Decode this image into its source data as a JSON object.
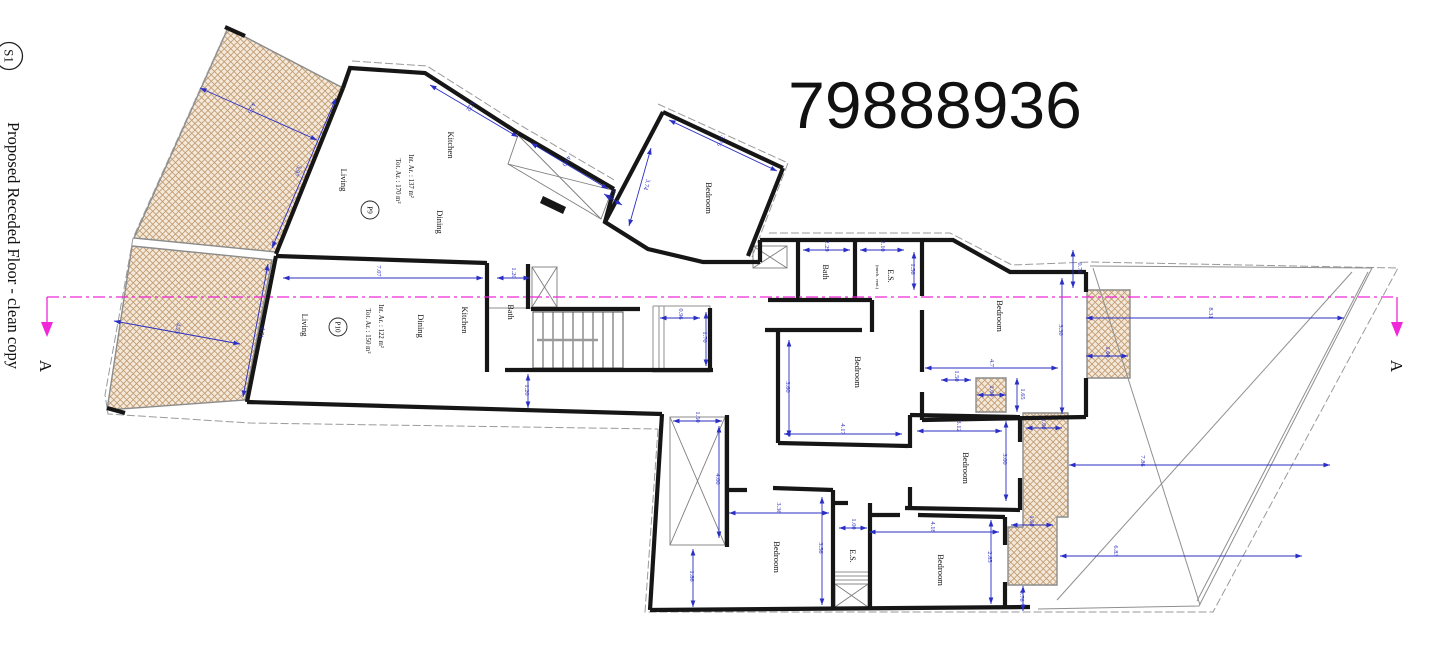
{
  "sheet": {
    "marker": "S1",
    "title": "Proposed Receded Floor - clean copy",
    "drawing_number": "79888936",
    "section_label": "A"
  },
  "apartments": [
    {
      "id": "P9",
      "int_area": "Int. Ar. : 137 m²",
      "tot_area": "Tot. Ar. : 170 m²"
    },
    {
      "id": "P10",
      "int_area": "Int. Ar. : 122 m²",
      "tot_area": "Tot. Ar. : 150 m²"
    }
  ],
  "colors": {
    "wall": "#161616",
    "dimension": "#2a2ec4",
    "section_line": "#ef27d8",
    "boundary": "#9a9a9a",
    "hatch_fill": "#f3e8da",
    "hatch_line": "#c09a6e"
  },
  "plan": {
    "hatches": [
      "228,28 343,88 276,252 134,238",
      "132,246 272,260 245,400 107,410",
      "1087,290 1130,290 1130,378 1087,378",
      "976,378 1006,378 1006,412 976,412",
      "1023,413 1068,413 1068,517 1057,517 1057,585 1008,585 1008,527 1023,527"
    ],
    "boundary": [
      "228,27 133,238 105,395 108,414 250,423 658,429",
      "658,429 645,612 1213,612 1398,268 1090,262 1012,265 950,233 766,233",
      "352,61 427,66 520,125 616,181",
      "658,104 788,163 752,257"
    ],
    "thin": [
      "1090,266 1372,268 1199,606 1038,609",
      "1093,268 1200,605",
      "1057,600 1352,272",
      "1368,272 1197,601",
      "653,306 710,306 710,372 653,372 653,306",
      "659,306 659,372",
      "664,306 664,372",
      "835,572 868,572",
      "835,576 868,576",
      "835,580 868,580",
      "487,308 531,308"
    ],
    "xboxes": [
      [
        532,
        267,
        25,
        40
      ],
      [
        753,
        246,
        34,
        22
      ],
      [
        835,
        584,
        33,
        23
      ],
      [
        670,
        417,
        55,
        128
      ]
    ],
    "xquads": [
      "518,135 612,190 601,219 508,164"
    ],
    "fills": [
      "543,196 566,207 563,214 540,203"
    ],
    "stairs": {
      "x": 533,
      "y": 312,
      "w": 90,
      "h": 56,
      "treads": 8
    },
    "walls": [
      "343,88 276,254",
      "343,88 350,68 425,73 518,133",
      "518,133 614,189",
      "614,189 605,222 648,249 703,262 760,262",
      "663,112 783,168",
      "663,112 605,222",
      "783,168 748,256",
      "760,240 953,240 1010,272 1086,272",
      "760,240 760,262",
      "1086,272 1086,292",
      "1086,378 1086,417",
      "798,240 798,302",
      "855,240 855,302",
      "922,240 922,296",
      "768,300 872,300",
      "872,300 872,332",
      "276,256 487,263",
      "487,263 487,372",
      "528,264 528,309",
      "531,309 640,309",
      "276,256 247,402",
      "247,402 662,414",
      "662,414 650,610",
      "650,610 1030,607",
      "505,370 713,370",
      "710,308 710,370",
      "727,415 727,547",
      "727,490 747,490",
      "773,488 833,490",
      "833,490 833,608",
      "870,503 870,608",
      "833,503 848,503",
      "778,332 778,443",
      "765,330 862,330",
      "778,443 908,446",
      "922,310 922,372",
      "922,392 922,420",
      "922,420 1086,417",
      "910,415 1020,417",
      "910,415 910,448",
      "910,487 910,508",
      "905,508 1020,510",
      "1020,417 1020,442",
      "1020,478 1020,510",
      "868,515 900,515",
      "918,515 1005,517",
      "1005,517 1005,545",
      "1005,582 1005,608",
      "225,27 245,36",
      "107,408 125,413"
    ],
    "dims": [
      {
        "t": "4.25",
        "x1": 200,
        "y1": 88,
        "x2": 317,
        "y2": 140,
        "lx": 250,
        "ly": 107,
        "r": 114
      },
      {
        "t": "5.97",
        "x1": 336,
        "y1": 98,
        "x2": 272,
        "y2": 248,
        "lx": 296,
        "ly": 170,
        "r": 113
      },
      {
        "t": "4.25",
        "x1": 114,
        "y1": 321,
        "x2": 240,
        "y2": 344,
        "lx": 176,
        "ly": 328,
        "r": 100
      },
      {
        "t": "4.71",
        "x1": 268,
        "y1": 264,
        "x2": 243,
        "y2": 397,
        "lx": 260,
        "ly": 332,
        "r": 101
      },
      {
        "t": "7.07",
        "x1": 283,
        "y1": 278,
        "x2": 483,
        "y2": 278,
        "lx": 377,
        "ly": 271,
        "r": 90
      },
      {
        "t": "3.22",
        "x1": 430,
        "y1": 85,
        "x2": 518,
        "y2": 137,
        "lx": 469,
        "ly": 105,
        "r": 121
      },
      {
        "t": "4.00",
        "x1": 531,
        "y1": 143,
        "x2": 608,
        "y2": 189,
        "lx": 565,
        "ly": 160,
        "r": 121
      },
      {
        "t": "1.50",
        "x1": 604,
        "y1": 194,
        "x2": 622,
        "y2": 205,
        "lx": 610,
        "ly": 194,
        "r": 121
      },
      {
        "t": "3.74",
        "x1": 651,
        "y1": 148,
        "x2": 629,
        "y2": 226,
        "lx": 645,
        "ly": 184,
        "r": 106
      },
      {
        "t": "3.76",
        "x1": 669,
        "y1": 120,
        "x2": 777,
        "y2": 171,
        "lx": 719,
        "ly": 140,
        "r": 115
      },
      {
        "t": "1.20",
        "x1": 497,
        "y1": 278,
        "x2": 530,
        "y2": 278,
        "lx": 512,
        "ly": 273,
        "r": 90
      },
      {
        "t": "0.96",
        "x1": 660,
        "y1": 318,
        "x2": 700,
        "y2": 318,
        "lx": 679,
        "ly": 314,
        "r": 90
      },
      {
        "t": "1.70",
        "x1": 706,
        "y1": 312,
        "x2": 706,
        "y2": 366,
        "lx": 703,
        "ly": 337,
        "r": 90
      },
      {
        "t": "1.20",
        "x1": 528,
        "y1": 374,
        "x2": 528,
        "y2": 408,
        "lx": 525,
        "ly": 390,
        "r": 90
      },
      {
        "t": "2.29",
        "x1": 803,
        "y1": 250,
        "x2": 850,
        "y2": 250,
        "lx": 825,
        "ly": 246,
        "r": 90
      },
      {
        "t": "2.10",
        "x1": 860,
        "y1": 250,
        "x2": 904,
        "y2": 250,
        "lx": 881,
        "ly": 246,
        "r": 90
      },
      {
        "t": "1.56",
        "x1": 914,
        "y1": 252,
        "x2": 914,
        "y2": 290,
        "lx": 911,
        "ly": 269,
        "r": 90
      },
      {
        "t": "3.30",
        "x1": 1062,
        "y1": 278,
        "x2": 1062,
        "y2": 414,
        "lx": 1059,
        "ly": 330,
        "r": 90
      },
      {
        "t": "4.7",
        "x1": 925,
        "y1": 368,
        "x2": 1058,
        "y2": 368,
        "lx": 990,
        "ly": 363,
        "r": 90
      },
      {
        "t": "0.76",
        "x1": 1073,
        "y1": 250,
        "x2": 1073,
        "y2": 288,
        "lx": 1078,
        "ly": 268,
        "r": 90
      },
      {
        "t": "1.60",
        "x1": 1086,
        "y1": 356,
        "x2": 1128,
        "y2": 356,
        "lx": 1106,
        "ly": 352,
        "r": 90
      },
      {
        "t": "8.31",
        "x1": 1086,
        "y1": 318,
        "x2": 1344,
        "y2": 318,
        "lx": 1209,
        "ly": 313,
        "r": 90
      },
      {
        "t": "1.50",
        "x1": 941,
        "y1": 380,
        "x2": 971,
        "y2": 380,
        "lx": 955,
        "ly": 376,
        "r": 90
      },
      {
        "t": "1.00",
        "x1": 977,
        "y1": 395,
        "x2": 1006,
        "y2": 395,
        "lx": 990,
        "ly": 391,
        "r": 90
      },
      {
        "t": "1.65",
        "x1": 1017,
        "y1": 378,
        "x2": 1017,
        "y2": 412,
        "lx": 1021,
        "ly": 394,
        "r": 90
      },
      {
        "t": "3.60",
        "x1": 789,
        "y1": 340,
        "x2": 789,
        "y2": 437,
        "lx": 786,
        "ly": 387,
        "r": 90
      },
      {
        "t": "4.17",
        "x1": 784,
        "y1": 434,
        "x2": 902,
        "y2": 434,
        "lx": 841,
        "ly": 429,
        "r": 90
      },
      {
        "t": "3.12",
        "x1": 917,
        "y1": 431,
        "x2": 1002,
        "y2": 431,
        "lx": 957,
        "ly": 426,
        "r": 90
      },
      {
        "t": "3.00",
        "x1": 1006,
        "y1": 421,
        "x2": 1006,
        "y2": 501,
        "lx": 1003,
        "ly": 459,
        "r": 90
      },
      {
        "t": "1.00",
        "x1": 1026,
        "y1": 428,
        "x2": 1062,
        "y2": 428,
        "lx": 1042,
        "ly": 424,
        "r": 90
      },
      {
        "t": "7.86",
        "x1": 1069,
        "y1": 465,
        "x2": 1330,
        "y2": 465,
        "lx": 1141,
        "ly": 461,
        "r": 90
      },
      {
        "t": "1.60",
        "x1": 1011,
        "y1": 525,
        "x2": 1053,
        "y2": 525,
        "lx": 1030,
        "ly": 521,
        "r": 90
      },
      {
        "t": "6.83",
        "x1": 1060,
        "y1": 556,
        "x2": 1302,
        "y2": 556,
        "lx": 1114,
        "ly": 551,
        "r": 90
      },
      {
        "t": "0.76",
        "x1": 1023,
        "y1": 586,
        "x2": 1023,
        "y2": 611,
        "lx": 1020,
        "ly": 596,
        "r": 90
      },
      {
        "t": "1.50",
        "x1": 673,
        "y1": 421,
        "x2": 722,
        "y2": 421,
        "lx": 696,
        "ly": 417,
        "r": 90
      },
      {
        "t": "4.00",
        "x1": 719,
        "y1": 426,
        "x2": 719,
        "y2": 538,
        "lx": 716,
        "ly": 479,
        "r": 90
      },
      {
        "t": "1.86",
        "x1": 693,
        "y1": 549,
        "x2": 693,
        "y2": 607,
        "lx": 690,
        "ly": 576,
        "r": 90
      },
      {
        "t": "3.36",
        "x1": 729,
        "y1": 513,
        "x2": 829,
        "y2": 513,
        "lx": 777,
        "ly": 508,
        "r": 90
      },
      {
        "t": "3.56",
        "x1": 822,
        "y1": 497,
        "x2": 822,
        "y2": 605,
        "lx": 819,
        "ly": 548,
        "r": 90
      },
      {
        "t": "1.00",
        "x1": 839,
        "y1": 528,
        "x2": 867,
        "y2": 528,
        "lx": 852,
        "ly": 524,
        "r": 90
      },
      {
        "t": "4.18",
        "x1": 869,
        "y1": 532,
        "x2": 999,
        "y2": 532,
        "lx": 931,
        "ly": 527,
        "r": 90
      },
      {
        "t": "2.85",
        "x1": 991,
        "y1": 520,
        "x2": 991,
        "y2": 604,
        "lx": 988,
        "ly": 557,
        "r": 90
      }
    ],
    "texts": [
      {
        "t": "Kitchen",
        "x": 448,
        "y": 145,
        "s": 8.5
      },
      {
        "t": "Living",
        "x": 341,
        "y": 180,
        "s": 8.5
      },
      {
        "t": "Dining",
        "x": 437,
        "y": 222,
        "s": 8.5
      },
      {
        "t": "Int. Ar. : 137 m²",
        "x": 409,
        "y": 176,
        "s": 6.8
      },
      {
        "t": "Tot. Ar. : 170 m²",
        "x": 396,
        "y": 181,
        "s": 6.8
      },
      {
        "t": "Kitchen",
        "x": 462,
        "y": 320,
        "s": 8.5
      },
      {
        "t": "Dining",
        "x": 418,
        "y": 326,
        "s": 8.5
      },
      {
        "t": "Living",
        "x": 302,
        "y": 325,
        "s": 8.5
      },
      {
        "t": "Int. Ar. : 122 m²",
        "x": 379,
        "y": 326,
        "s": 6.8
      },
      {
        "t": "Tot. Ar. : 150 m²",
        "x": 366,
        "y": 331,
        "s": 6.8
      },
      {
        "t": "Bath",
        "x": 508,
        "y": 312,
        "s": 8
      },
      {
        "t": "Bath",
        "x": 823,
        "y": 272,
        "s": 8
      },
      {
        "t": "E.S.",
        "x": 888,
        "y": 276,
        "s": 8
      },
      {
        "t": "(mech. vent.)",
        "x": 876,
        "y": 277,
        "s": 4.6
      },
      {
        "t": "Bedroom",
        "x": 706,
        "y": 198,
        "s": 8.5
      },
      {
        "t": "Bedroom",
        "x": 997,
        "y": 316,
        "s": 8.5
      },
      {
        "t": "Bedroom",
        "x": 855,
        "y": 372,
        "s": 8.5
      },
      {
        "t": "Bedroom",
        "x": 963,
        "y": 468,
        "s": 8.5
      },
      {
        "t": "Bedroom",
        "x": 774,
        "y": 557,
        "s": 8.5
      },
      {
        "t": "E.S.",
        "x": 850,
        "y": 556,
        "s": 8
      },
      {
        "t": "Bedroom",
        "x": 938,
        "y": 570,
        "s": 8.5
      }
    ],
    "tags": [
      {
        "t": "P9",
        "x": 370,
        "y": 210
      },
      {
        "t": "P10",
        "x": 338,
        "y": 327
      }
    ]
  }
}
